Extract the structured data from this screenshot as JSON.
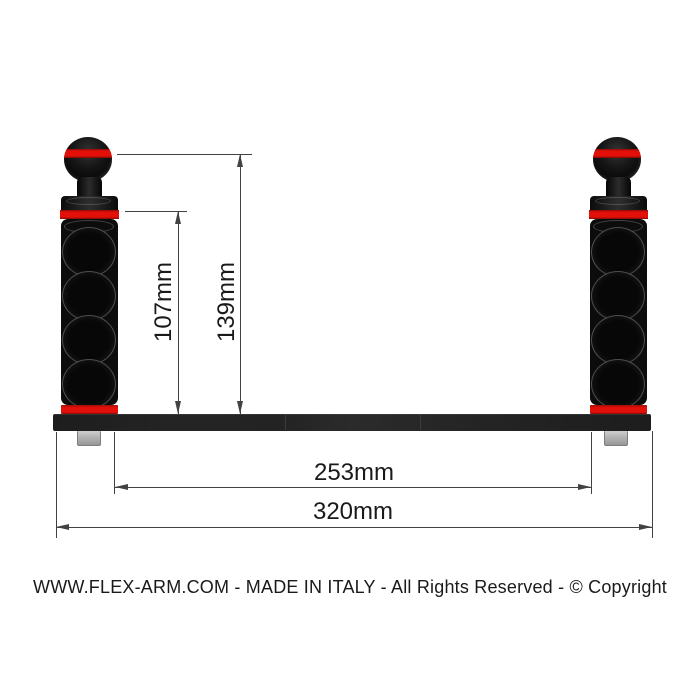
{
  "diagram": {
    "product": "flex-arm-double-handle-tray",
    "caption": "WWW.FLEX-ARM.COM  - MADE IN ITALY - All Rights Reserved - © Copyright",
    "dimensions": {
      "ball_top_to_tray": "139mm",
      "arm_top_to_tray": "107mm",
      "inner_span": "253mm",
      "overall_length": "320mm"
    },
    "colors": {
      "accent_red": "#e31009",
      "part_black": "#161616",
      "bolt_gray": "#b5b5b5",
      "dim_line": "#424242",
      "text": "#1a1a1a",
      "background": "#ffffff"
    }
  }
}
